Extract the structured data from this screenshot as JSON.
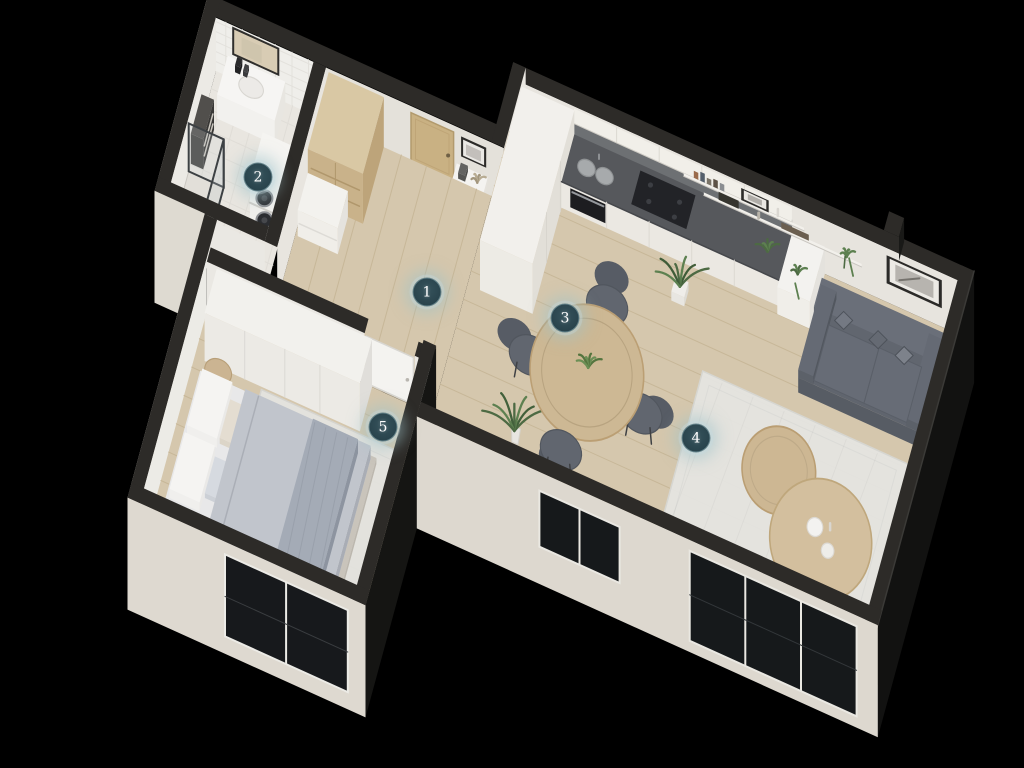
{
  "scene_title": "apartment-3d-floor-plan",
  "markers": [
    {
      "label": "1",
      "x": 427,
      "y": 292
    },
    {
      "label": "2",
      "x": 258,
      "y": 177
    },
    {
      "label": "3",
      "x": 565,
      "y": 318
    },
    {
      "label": "4",
      "x": 696,
      "y": 438
    },
    {
      "label": "5",
      "x": 383,
      "y": 427
    }
  ],
  "marker_style": {
    "fill": "#2c4750",
    "text_color": "#ffffff",
    "glow": "rgba(160,195,202,0.5)"
  },
  "palette": {
    "background": "#000000",
    "wall_top": "#2d2b28",
    "wall_light": "#e2ddd4",
    "wall_inner": "#e7e4de",
    "tile": "#efeeea",
    "floor_wood": "#d5c7ad",
    "plank_line": "#c7b798",
    "bath_floor": "#e9e6e0",
    "rug": "#e5e5e1",
    "sofa": "#585d66",
    "sofa_light": "#686d77",
    "wood": "#cdb894",
    "wood_dark": "#bb9f74",
    "counter_top": "#56585c",
    "backsplash": "#6d7073",
    "cabinet": "#eeece6",
    "glass_dark": "#16191b",
    "green_dark": "#4d6a43",
    "green_light": "#5d8050",
    "blanket": "#b6bac2",
    "throw": "#99a0ab",
    "mattress": "#e8e8e9",
    "door_wood": "#c9b183"
  }
}
